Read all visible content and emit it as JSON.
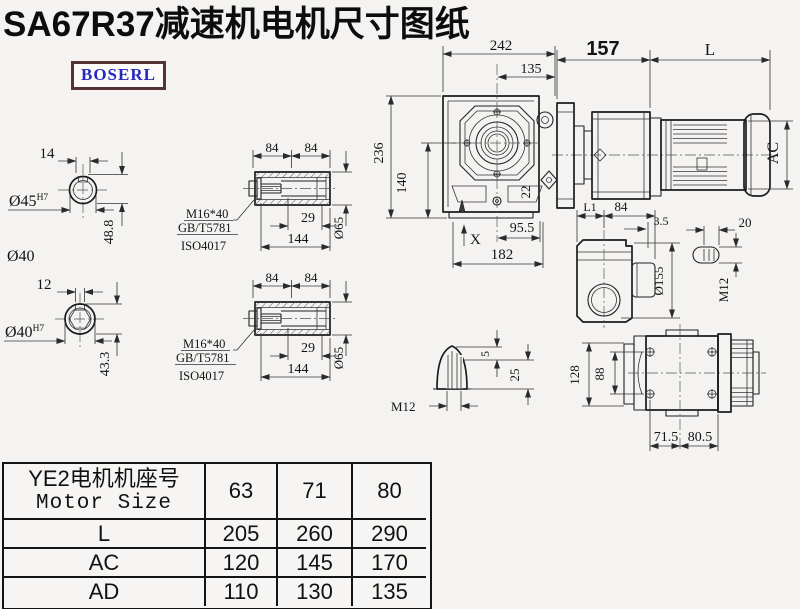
{
  "page": {
    "title": "SA67R37减速机电机尺寸图纸",
    "brand": "BOSERL"
  },
  "d": {
    "s1": {
      "w": "14",
      "bore": "Ø45",
      "tol": "H7",
      "h": "48.8",
      "outer": "Ø40"
    },
    "s2": {
      "w": "12",
      "bore": "Ø40",
      "tol": "H7",
      "h": "43.3"
    },
    "h1": {
      "a": "84",
      "b": "84",
      "bolt": "M16*40",
      "std1": "GB/T5781",
      "std2": "ISO4017",
      "depth": "29",
      "len": "144",
      "dia": "Ø65"
    },
    "h2": {
      "a": "84",
      "b": "84",
      "bolt": "M16*40",
      "std1": "GB/T5781",
      "std2": "ISO4017",
      "depth": "29",
      "len": "144",
      "dia": "Ø65"
    },
    "fv": {
      "w": "242",
      "cf": "135",
      "h": "236",
      "ch": "140",
      "foot": "22",
      "xmark": "X",
      "ce": "95.5",
      "base": "182"
    },
    "mv": {
      "adapter": "157",
      "len": "L",
      "dia": "AC"
    },
    "sv": {
      "l1": "L1",
      "len": "84",
      "wall": "3.5",
      "slot": "20",
      "dia": "Ø155",
      "thread": "M12"
    },
    "pv": {
      "t": "5",
      "h": "25",
      "thread": "M12"
    },
    "bv": {
      "h": "128",
      "inner": "88",
      "a": "71.5",
      "b": "80.5"
    }
  },
  "table": {
    "header_cn": "YE2电机机座号",
    "header_en": "Motor Size",
    "cols": [
      "63",
      "71",
      "80"
    ],
    "rows": [
      {
        "label": "L",
        "values": [
          "205",
          "260",
          "290"
        ]
      },
      {
        "label": "AC",
        "values": [
          "120",
          "145",
          "170"
        ]
      },
      {
        "label": "AD",
        "values": [
          "110",
          "130",
          "135"
        ]
      }
    ]
  }
}
